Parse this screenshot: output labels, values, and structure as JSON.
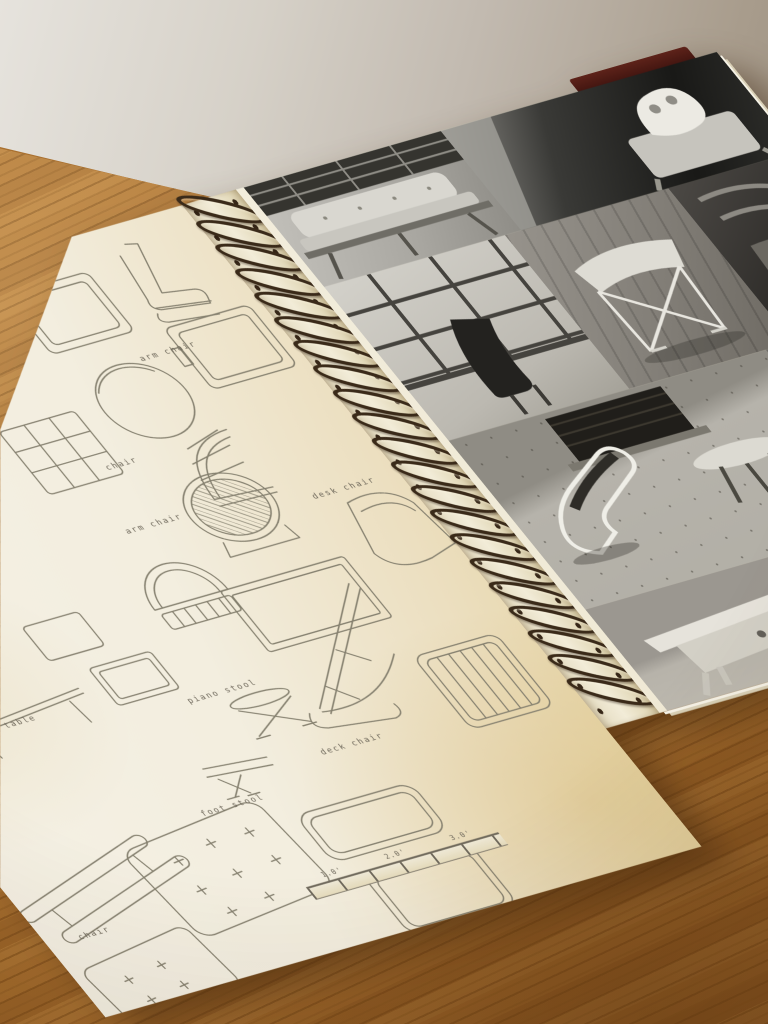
{
  "scene": {
    "description": "Photograph of an open spiral-bound furniture design scrapbook lying on an oak table against a pale wall",
    "wall_color": "#c9c2b6",
    "table_wood_color": "#a9702f"
  },
  "book": {
    "left_page": {
      "description": "Cream page of typed technical line drawings of furniture",
      "labels": [
        {
          "text": "arm chair"
        },
        {
          "text": "chair"
        },
        {
          "text": "arm chair"
        },
        {
          "text": "desk chair"
        },
        {
          "text": "piano stool"
        },
        {
          "text": "table"
        },
        {
          "text": "deck chair"
        },
        {
          "text": "foot stool"
        },
        {
          "text": "chair"
        }
      ],
      "scale_ruler": {
        "ticks": [
          "1.0'",
          "2.0'",
          "3.0'"
        ]
      },
      "sketches": [
        "side-profile-chair",
        "seat-frame-panel",
        "seat-frame-panel-2",
        "shelf-unit",
        "round-table-top",
        "fan-back-chair",
        "dome-chair",
        "lattice-back-chair",
        "tub-chair",
        "rectangular-table",
        "small-table-panels",
        "long-thin-table",
        "x-base-stool",
        "folding-deck-chair",
        "slatted-frame",
        "foot-stool-sketch",
        "tufted-cushion",
        "rounded-frame",
        "bench-rails",
        "tufted-cushion-2",
        "rounded-frame-2"
      ]
    },
    "spiral": {
      "coil_count": 21,
      "coil_color": "#3a2a19"
    },
    "right_page": {
      "description": "Collage of black-and-white photographs of modern furniture",
      "photos": [
        {
          "name": "daybed-sofa-interior"
        },
        {
          "name": "sculpture-on-armchair"
        },
        {
          "name": "chair-by-window-grid"
        },
        {
          "name": "folding-stool-with-cushion"
        },
        {
          "name": "dark-wood-chair-detail"
        },
        {
          "name": "tubular-lounge-chair-by-fireplace"
        },
        {
          "name": "wood-floor-detail"
        },
        {
          "name": "light-wood-desk"
        },
        {
          "name": "plain-wall-detail"
        }
      ],
      "cover_edge_color": "#4a1a12"
    }
  }
}
